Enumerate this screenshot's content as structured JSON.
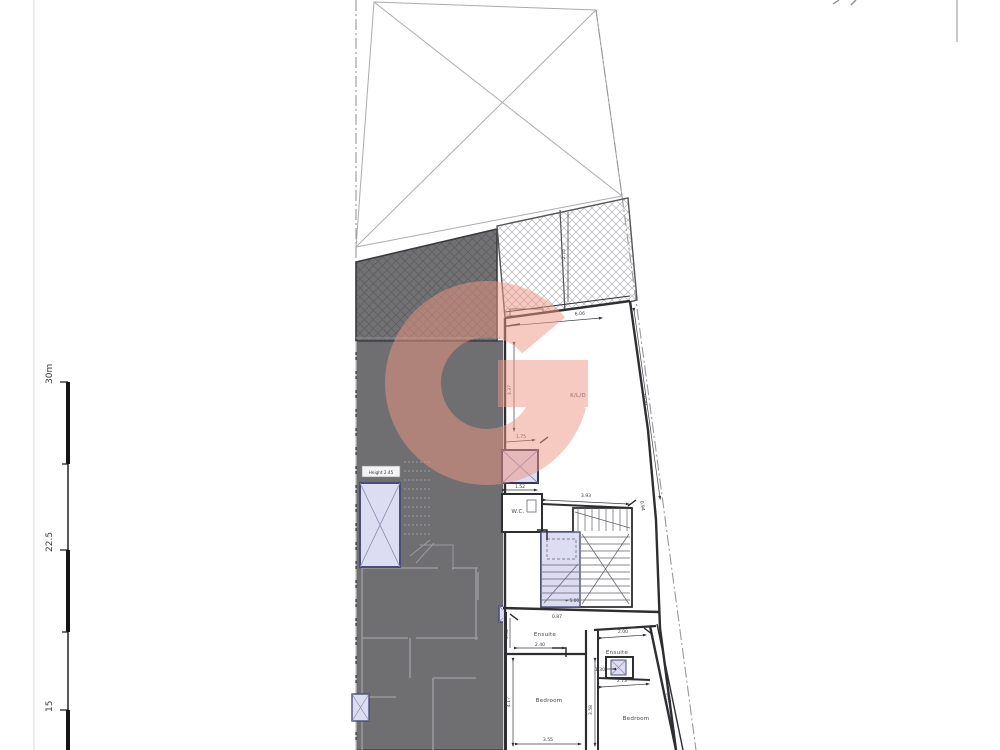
{
  "drawing": {
    "type": "architectural-floor-plan",
    "watermark": {
      "letter": "G",
      "color": "#EF9682",
      "opacity": 0.5
    },
    "scale_bar": {
      "labels": [
        "30m",
        "22.5",
        "15"
      ]
    },
    "labels": {
      "kld": "K/L/D",
      "wc": "W.C.",
      "ensuite_left": "Ensuite",
      "bedroom_left": "Bedroom",
      "ensuite_right": "Ensuite",
      "bedroom_right": "Bedroom",
      "height_note": "Height 2.45",
      "level_note": "+ 5.00"
    },
    "dimensions": {
      "kld_top_width": "6.06",
      "kld_left_depth": "3.37",
      "terrace_depth": "2.75",
      "shaft_top": "1.75",
      "shaft_bottom": "1.52",
      "hall_width": "3.93",
      "stair_offset": "0.94",
      "boundary_right": "10.91",
      "ensuite_l_width": "2.40",
      "ensuite_l_door": "0.87",
      "ensuite_l_side": "0.92",
      "bedroom_l_depth": "4.17",
      "bedroom_l_width": "3.55",
      "ensuite_r_width": "2.00",
      "shaft_r_width": "1.30",
      "ensuite_r_inner": "2.73",
      "bedroom_r_depth": "3.58",
      "boundary_lower": "3.47"
    },
    "colors": {
      "building_fill": "#6f6f72",
      "shaft_fill": "#dcdcf2",
      "wall_line": "#2e2e32",
      "boundary_line": "#999999"
    }
  }
}
